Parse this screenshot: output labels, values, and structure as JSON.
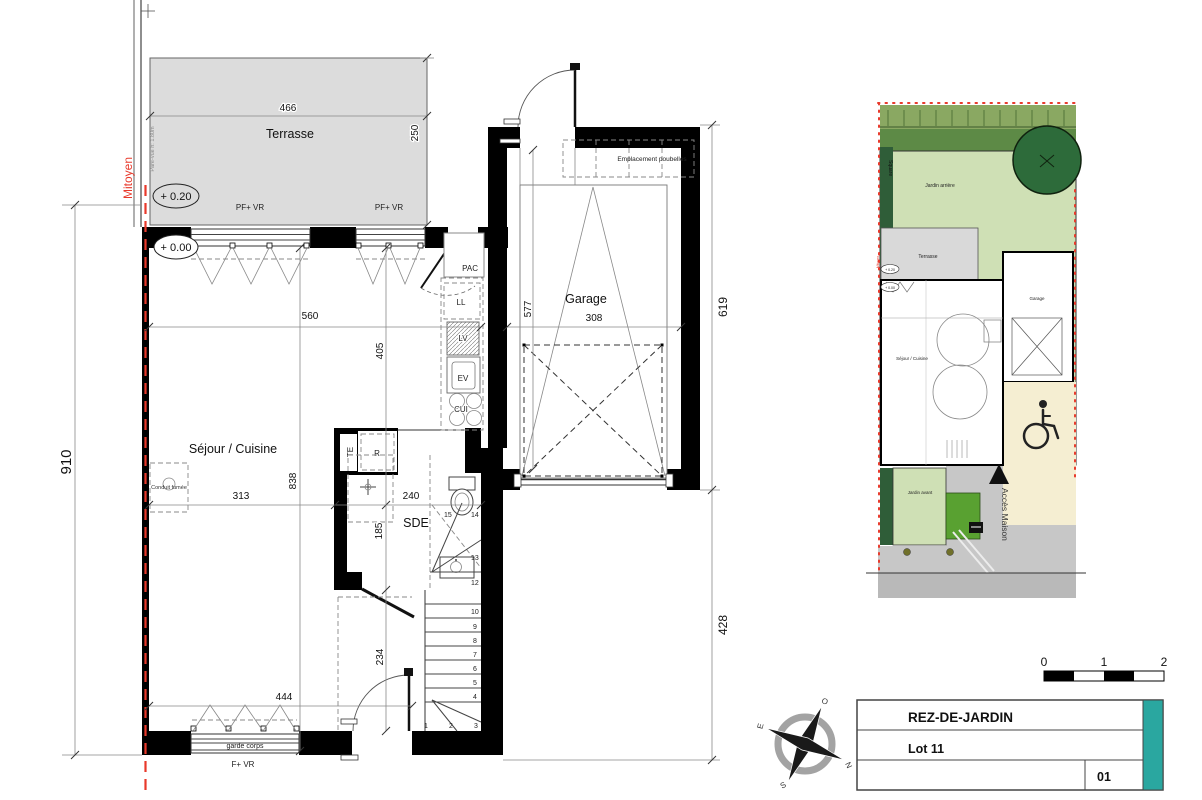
{
  "floorplan": {
    "rooms": {
      "terrasse": "Terrasse",
      "sejour_cuisine": "Séjour / Cuisine",
      "sde": "SDE",
      "garage": "Garage"
    },
    "annotations": {
      "mitoyen": "Mitoyen",
      "pare_vue": "Pare-vue h: 1.80m",
      "level_plus_020": "+ 0.20",
      "level_plus_000": "+ 0.00",
      "pf_vr_left": "PF+ VR",
      "pf_vr_right": "PF+ VR",
      "f_vr": "F+ VR",
      "garde_corps": "garde corps",
      "conduit_fumee": "Conduit fumée",
      "emplacement_poubelles": "Emplacement poubelles"
    },
    "equipment": {
      "pac": "PAC",
      "ll": "LL",
      "lv": "LV",
      "ev": "EV",
      "cui": "CUI",
      "te": "TE",
      "r": "R"
    },
    "dimensions": {
      "terrace_width": "466",
      "terrace_depth": "250",
      "overall_depth": "910",
      "sejour_width": "560",
      "kitchen_depth": "405",
      "sejour_depth": "838",
      "sejour_lower_width": "313",
      "sde_width": "240",
      "sde_depth": "185",
      "hall_depth": "234",
      "bottom_width": "444",
      "garage_width": "308",
      "garage_depth": "577",
      "garage_side_depth": "619",
      "right_lower_depth": "428"
    },
    "stair_steps": [
      "1",
      "2",
      "3",
      "4",
      "5",
      "6",
      "7",
      "8",
      "9",
      "10",
      "12",
      "13",
      "14",
      "15"
    ]
  },
  "siteplan": {
    "jardin_arriere": "Jardin arrière",
    "jardin_avant": "Jardin avant",
    "terrasse": "Terrasse",
    "sejour_cuisine": "Séjour / Cuisine",
    "garage": "Garage",
    "acces_maison": "Accès Maison",
    "street": "Square",
    "mitoyen": "Mitoyen",
    "level_plus_020": "+ 0.20",
    "level_plus_000": "+ 0.00"
  },
  "compass": {
    "n": "N",
    "s": "S",
    "e": "E",
    "o": "O"
  },
  "scale_bar": {
    "start": "0",
    "mid": "1",
    "end": "2"
  },
  "title_block": {
    "level": "REZ-DE-JARDIN",
    "lot": "Lot 11",
    "sheet_number": "01",
    "accent_color": "#2aa7a0"
  },
  "colors": {
    "property_line_red": "#e8392b",
    "terrace_gray": "#dcdcdc",
    "garden_light_green": "#cfe0b5",
    "hedge_dark_green": "#2f5d38",
    "lawn_bright_green": "#59a131",
    "paving_gray": "#c7c7c7",
    "handicap_beige": "#f5eed2",
    "accent_teal": "#2aa7a0"
  }
}
